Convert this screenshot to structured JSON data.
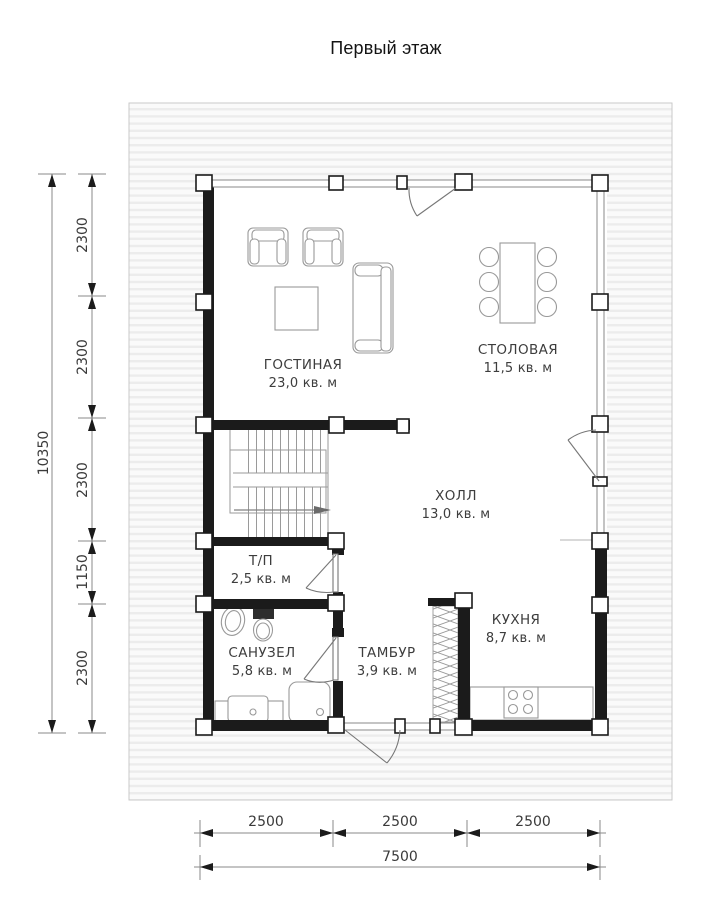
{
  "title": "Первый этаж",
  "rooms": [
    {
      "name": "ГОСТИНАЯ",
      "area": "23,0 кв. м"
    },
    {
      "name": "СТОЛОВАЯ",
      "area": "11,5 кв. м"
    },
    {
      "name": "ХОЛЛ",
      "area": "13,0 кв. м"
    },
    {
      "name": "Т/П",
      "area": "2,5 кв. м"
    },
    {
      "name": "САНУЗЕЛ",
      "area": "5,8 кв. м"
    },
    {
      "name": "ТАМБУР",
      "area": "3,9 кв. м"
    },
    {
      "name": "КУХНЯ",
      "area": "8,7 кв. м"
    }
  ],
  "dimensions": {
    "left_total": "10350",
    "left_segments": [
      "2300",
      "2300",
      "2300",
      "1150",
      "2300"
    ],
    "bottom_segments": [
      "2500",
      "2500",
      "2500"
    ],
    "bottom_total": "7500"
  },
  "colors": {
    "wall": "#1b1b1b",
    "thin_line": "#8a8a8a",
    "furniture": "#999999",
    "deck_stripe": "#ececec"
  }
}
